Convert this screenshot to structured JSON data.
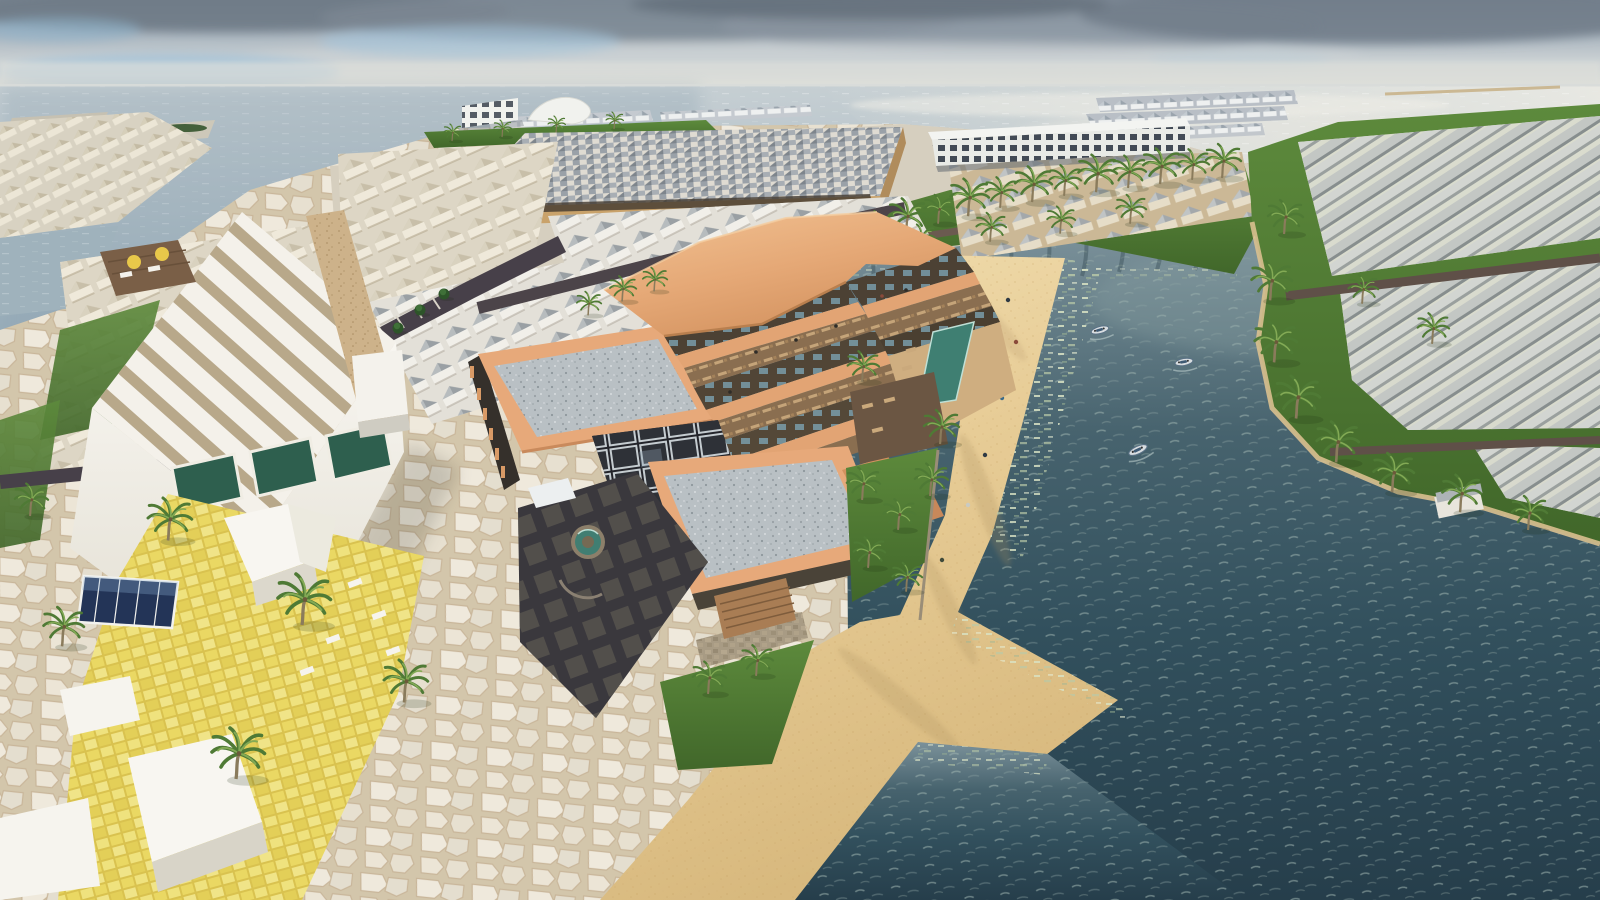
{
  "meta": {
    "title": "Aerial 3D rendering of a coastal resort masterplan",
    "type": "architectural-render",
    "view": "aerial-oblique",
    "time_of_day": "overcast daylight with sun glint on the sea"
  },
  "caption": "Aerial rendering of a beachfront resort: terracotta hotel with stepped terraces and podium roofs, villa clusters, yellow-tiled beach club, sandy spit and dark teal lagoon with boats, palm-lined lawns and sea horizon",
  "palette": {
    "c_sky_top": "#7d8996",
    "c_sea": "#a9bbc6",
    "c_lagoon": "#35525f",
    "c_sand": "#e7cc96",
    "c_lawn": "#527c33",
    "c_roof_orange": "#e9b583",
    "c_terracotta": "#e2a474",
    "c_wall_tan": "#c9a26a",
    "c_floor_dark": "#4c4134",
    "c_wood": "#8a6e50",
    "c_white_bld": "#f2f0e9",
    "c_stripe_tan": "#b8a88a",
    "c_road": "#453e44",
    "c_plaza_dark": "#3a383d",
    "c_flagstone": "#e9e3d5",
    "c_ytile": "#e7d463",
    "c_pool": "#3f7f72",
    "c_glass_dark": "#26262b",
    "c_palm": "#4f7a35",
    "c_palm_light": "#83aa55",
    "c_trunk": "#8a7b5c",
    "c_villa_wall": "#efe9da",
    "c_villa_roof": "#c8bfa9",
    "c_villa_roof_grey": "#9aa0a4",
    "c_boat": "#d8dde0",
    "c_podium_roof": "#b9c0c4",
    "c_wood_dark": "#6b5643",
    "c_stone": "#a89b84"
  },
  "scene": {
    "sky": {
      "cloud_cover": "broken grey clouds with blue gaps",
      "horizon_y_px": 86
    },
    "sea": {
      "sun_glint_side": "right",
      "pier_count": 1,
      "reef_streaks": 4
    },
    "lagoon": {
      "water": "dark teal with ripple sparkle",
      "boat_count": 3
    },
    "beach": {
      "people_count": 6,
      "sand_spit": true,
      "water_wedge": true
    },
    "resort_hotel": {
      "floors": 4,
      "podium_roofs": 2,
      "skylight_grid": true,
      "courtyard_fountain": true,
      "lap_pool": true,
      "stepped_terraces": 3,
      "lounge_chairs": true
    },
    "conference_hall": {
      "roof": "checkered skylight grid",
      "amphitheater_steps": true
    },
    "white_hall": {
      "roof": "ribbed diagonal stripes",
      "green_glass_panels": 3
    },
    "beach_club": {
      "paving": "yellow tiles",
      "white_pavilions": 4,
      "glass_skylight": 1,
      "umbrellas": 2
    },
    "villa_clusters": 9,
    "overwater_bungalow_rows": 3,
    "white_hotel_block": {
      "window_grid": true
    },
    "right_shore": {
      "villa_rows": 3,
      "palm_lined": true
    },
    "palm_trees_approx": 45
  }
}
